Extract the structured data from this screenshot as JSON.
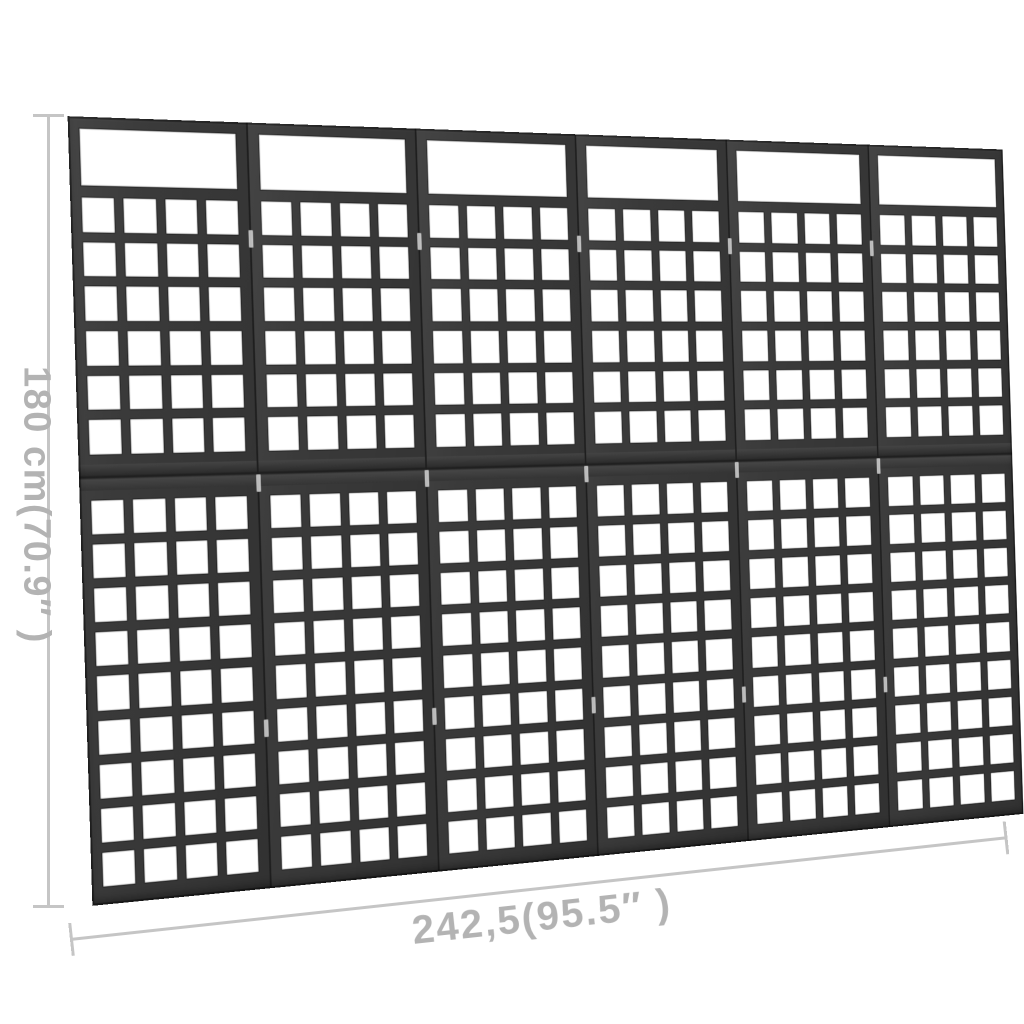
{
  "page": {
    "background": "#ffffff"
  },
  "scene": {
    "subject": "6-panel wooden trellis room divider, black, shown in perspective with dimension annotations",
    "colors": {
      "page_bg": "#ffffff",
      "wood": "#3a3a3a",
      "seam": "#1e1e1e",
      "opening": "#ffffff",
      "hinge": "#d6d6d6",
      "dimension": "#c5c5c5",
      "label": "#b3b3b3"
    },
    "structure": {
      "panels": 6,
      "columns": 4,
      "upper_rows": 6,
      "lower_rows": 9,
      "top_window": true,
      "hinge_positions_pct": [
        14,
        46,
        78
      ]
    }
  },
  "dimensions": {
    "height_label": "180 cm(70.9″ )",
    "width_label": "242,5(95.5″ )"
  }
}
